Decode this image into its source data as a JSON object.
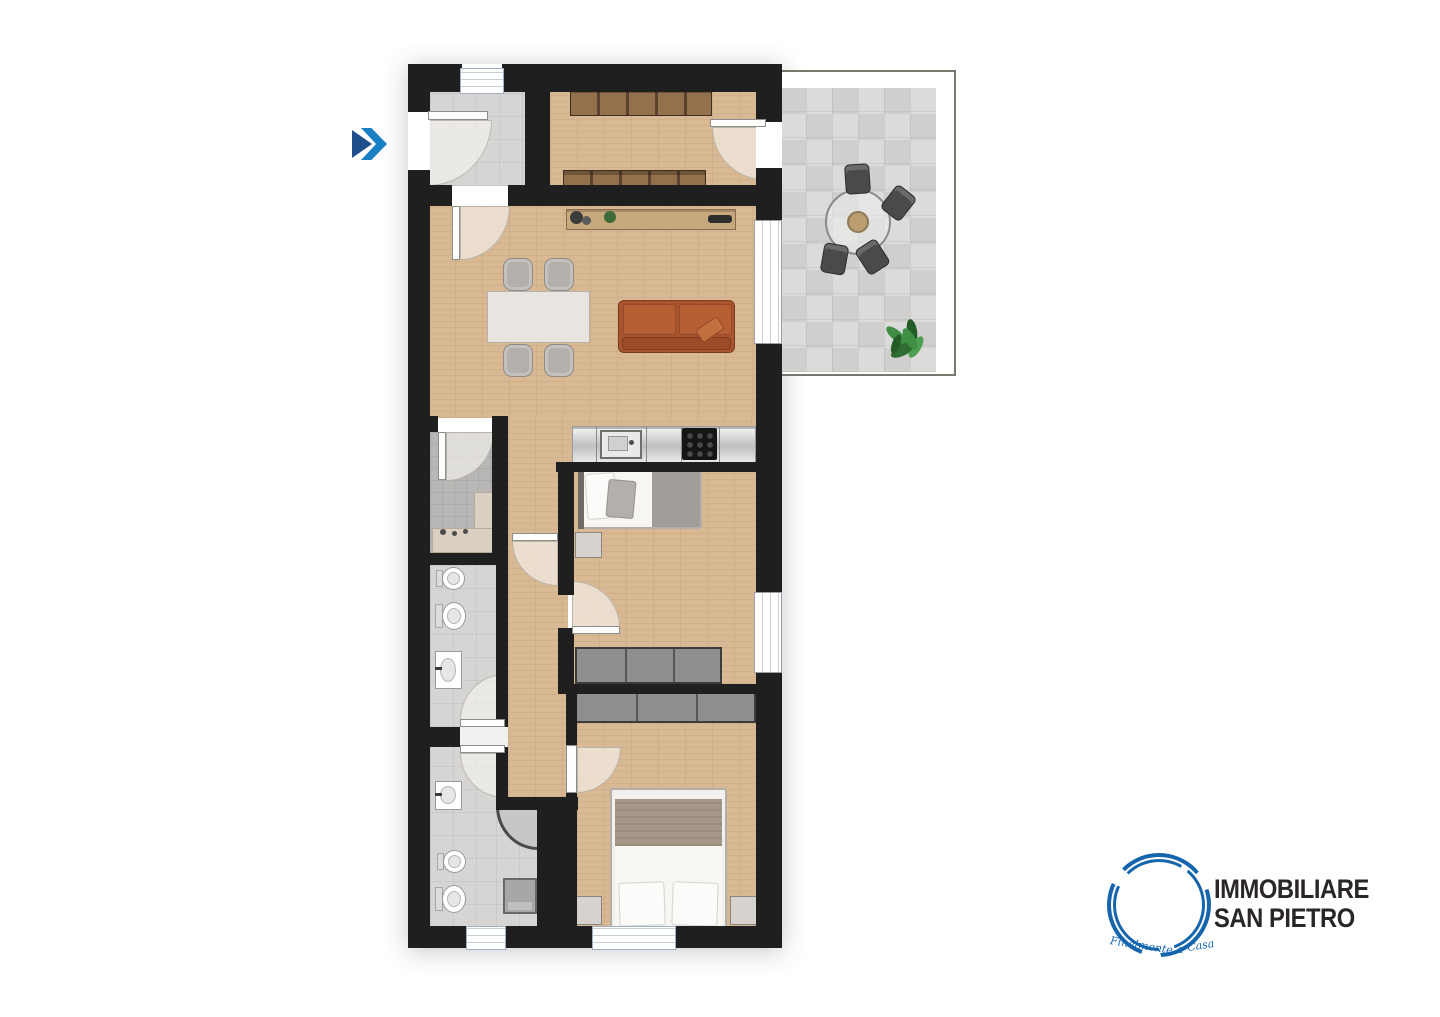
{
  "page": {
    "background": "#ffffff"
  },
  "brand": {
    "name_line1": "IMMOBILIARE",
    "name_line2": "SAN PIETRO",
    "tagline_parts": [
      "Finalmente",
      "a",
      "Casa"
    ],
    "logo_blue": "#1565ad",
    "text_color": "#2a2627"
  },
  "entry_marker": {
    "icon": "double-chevron-right-icon",
    "color_back": "#1e4f8d",
    "color_front": "#1a80c6"
  },
  "palette": {
    "wall": "#1f1f1f",
    "wood_floor": "#d8b994",
    "tile_light": "#d6d5d3",
    "tile_terrace": "#d7d6d4",
    "tile_shower": "#b9b7b5",
    "cabinet_brown": "#94714d",
    "wardrobe_gray": "#8f8f8d",
    "sofa_orange": "#b65f35",
    "bed_blanket": "#a59888"
  },
  "floor_plan": {
    "rooms": [
      {
        "name": "entrance-hall",
        "floor": "tile",
        "features": [
          "entry-door"
        ]
      },
      {
        "name": "walk-in-closet",
        "floor": "wood",
        "furniture": [
          "cabinet-row-top",
          "cabinet-row-bottom"
        ],
        "features": [
          "door-to-terrace"
        ]
      },
      {
        "name": "living-room-kitchen",
        "floor": "wood",
        "furniture": [
          "console-table",
          "decor-vases",
          "dining-table",
          "dining-chairs-x4",
          "sofa",
          "sofa-pillow",
          "kitchen-counter",
          "kitchen-sink",
          "cooktop"
        ],
        "features": [
          "terrace-window"
        ]
      },
      {
        "name": "terrace",
        "floor": "tile",
        "furniture": [
          "round-table",
          "outdoor-chairs-x4",
          "potted-plant"
        ]
      },
      {
        "name": "shower-room",
        "floor": "tile",
        "furniture": [
          "shower-bench",
          "shower-fittings"
        ]
      },
      {
        "name": "bathroom-1",
        "floor": "tile",
        "furniture": [
          "bidet",
          "toilet",
          "washbasin"
        ]
      },
      {
        "name": "corridor",
        "floor": "wood"
      },
      {
        "name": "bedroom-1",
        "floor": "wood",
        "furniture": [
          "single-bed",
          "nightstand",
          "wardrobe"
        ],
        "features": [
          "window-right"
        ]
      },
      {
        "name": "bathroom-2",
        "floor": "tile",
        "furniture": [
          "washbasin",
          "bidet",
          "toilet",
          "corner-shower",
          "washing-machine"
        ],
        "features": [
          "window-bottom"
        ]
      },
      {
        "name": "bedroom-2",
        "floor": "wood",
        "furniture": [
          "double-bed",
          "nightstand-left",
          "nightstand-right",
          "wardrobe"
        ],
        "features": [
          "window-bottom"
        ]
      }
    ],
    "door_count": 9,
    "window_count": 6
  }
}
